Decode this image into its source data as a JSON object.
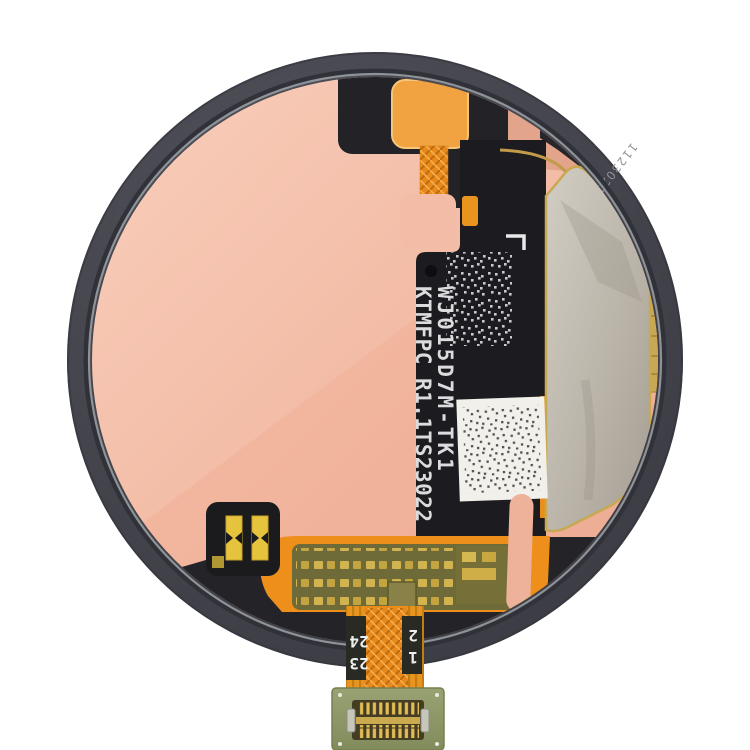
{
  "markings": {
    "part_line1": "WJ015D7M-TK1",
    "part_line2": "KTMFPC R1.1TS23022",
    "bezel_serial": "11230217",
    "flex_pins": {
      "left": [
        "23",
        "24"
      ],
      "right": [
        "1",
        "2"
      ]
    }
  },
  "colors": {
    "background": "#ffffff",
    "case_bezel": "#47474f",
    "coil_copper": "#f0b49c",
    "flex_orange": "#ee8f1c",
    "flex_black": "#1c1c20",
    "shield_gray": "#b8b2a7",
    "shield_gold_trim": "#c8a850",
    "label_white": "#f2f0ea",
    "component_olive": "#6f6b39",
    "pad_gold": "#d6b851",
    "pcb_green": "#90996a",
    "connector_gold": "#e3bc55",
    "text_white": "#dcdcde",
    "text_gray": "#8f8f97"
  }
}
